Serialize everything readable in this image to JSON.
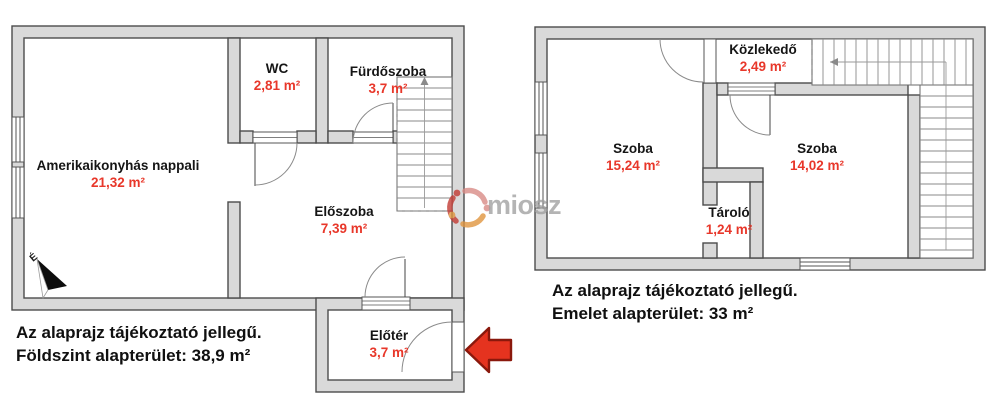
{
  "watermark": {
    "text": "miosz"
  },
  "colors": {
    "wall_fill": "#d9d9d9",
    "wall_outline": "#4c4c4c",
    "room_text": "#151515",
    "area_text": "#e8372a",
    "arrow_red": "#e5331f",
    "arrow_red_outline": "#8a180c"
  },
  "ground_floor": {
    "north_label": "É",
    "rooms": [
      {
        "name": "Amerikaikonyhás nappali",
        "area": "21,32 m²"
      },
      {
        "name": "WC",
        "area": "2,81 m²"
      },
      {
        "name": "Fürdőszoba",
        "area": "3,7 m²"
      },
      {
        "name": "Előszoba",
        "area": "7,39 m²"
      },
      {
        "name": "Előtér",
        "area": "3,7 m²"
      }
    ],
    "caption_line1": "Az alaprajz tájékoztató jellegű.",
    "caption_line2": "Földszint alapterület: 38,9 m²"
  },
  "upper_floor": {
    "rooms": [
      {
        "name": "Szoba",
        "area": "15,24 m²"
      },
      {
        "name": "Szoba",
        "area": "14,02 m²"
      },
      {
        "name": "Közlekedő",
        "area": "2,49 m²"
      },
      {
        "name": "Tároló",
        "area": "1,24 m²"
      }
    ],
    "caption_line1": "Az alaprajz tájékoztató jellegű.",
    "caption_line2": "Emelet alapterület: 33 m²"
  }
}
